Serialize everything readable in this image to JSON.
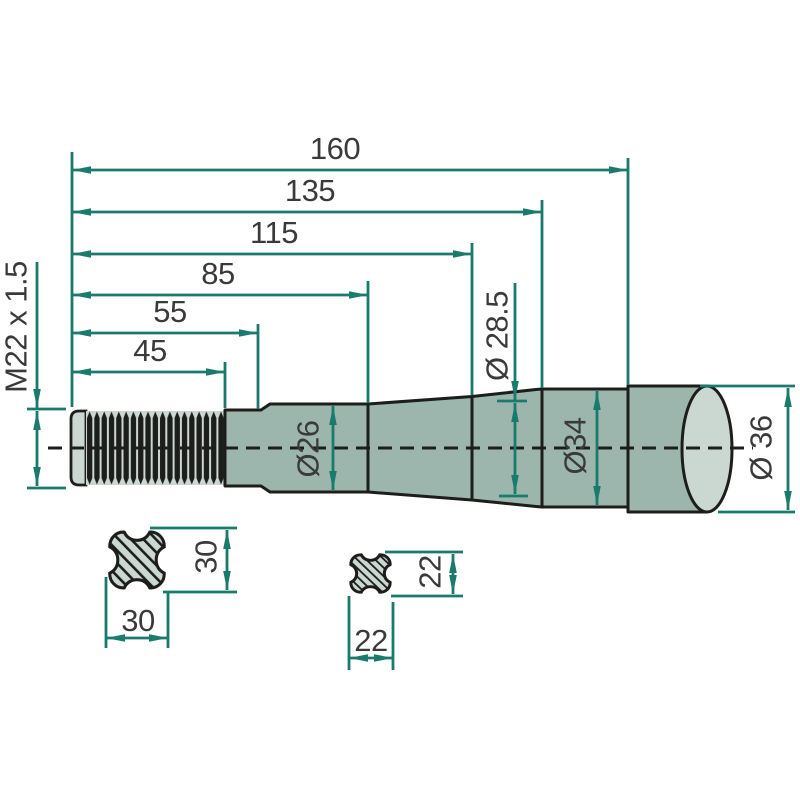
{
  "drawing": {
    "type": "technical-dimension-drawing",
    "part": "pointed shaft / loader tine shaft side view with two cross sections",
    "length_dims": [
      {
        "value": "160"
      },
      {
        "value": "135"
      },
      {
        "value": "115"
      },
      {
        "value": "85"
      },
      {
        "value": "55"
      },
      {
        "value": "45"
      }
    ],
    "thread": {
      "label": "M22 x 1.5"
    },
    "diameters": [
      {
        "value": "Ø 28.5"
      },
      {
        "value": "Ø26"
      },
      {
        "value": "Ø34"
      },
      {
        "value": "Ø 36"
      }
    ],
    "sections": [
      {
        "width_label": "30",
        "height_label": "30"
      },
      {
        "width_label": "22",
        "height_label": "22"
      }
    ],
    "colors": {
      "dimension_lines": "#1a7a6b",
      "body_fill": "#9db6ad",
      "light_fill": "#cbd7d1",
      "outline": "#1d1d1b",
      "text": "#3a3a39",
      "background": "#ffffff"
    }
  }
}
